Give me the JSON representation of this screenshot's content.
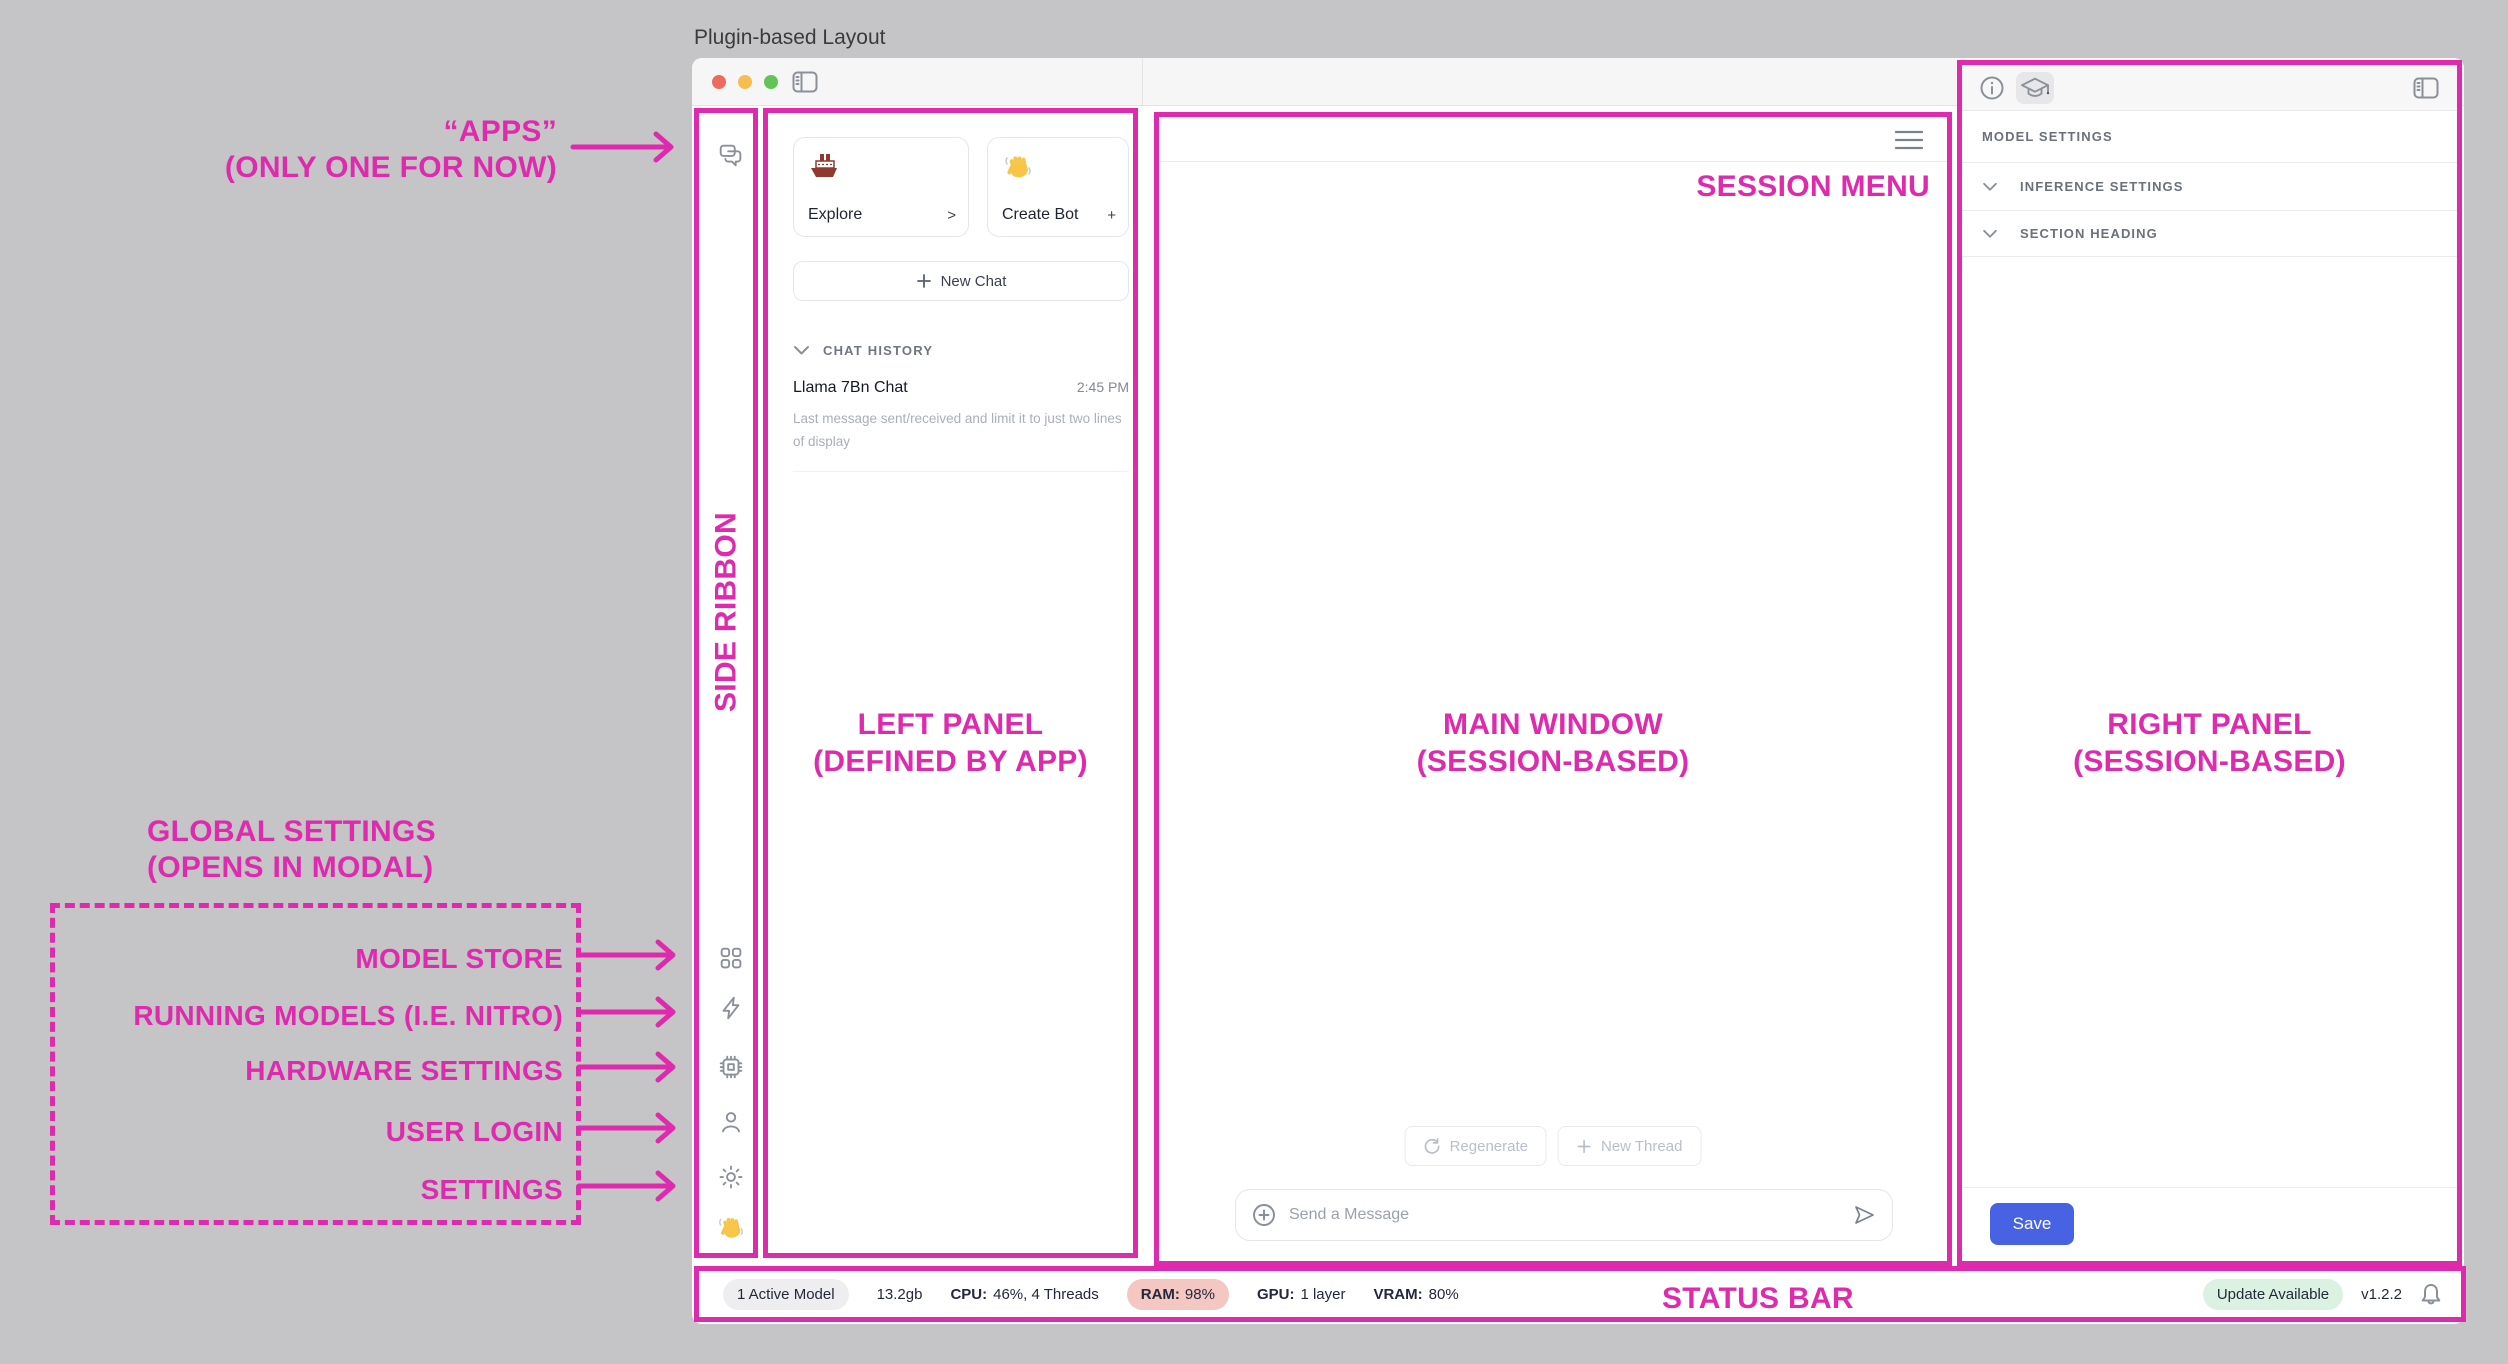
{
  "page": {
    "title": "Plugin-based Layout"
  },
  "side_ribbon": {
    "app_icons": [
      {
        "name": "chat-bubbles"
      }
    ],
    "global_icons": [
      {
        "name": "model-store-grid"
      },
      {
        "name": "running-models-bolt"
      },
      {
        "name": "hardware-cpu"
      },
      {
        "name": "user-login"
      },
      {
        "name": "settings-gear"
      },
      {
        "name": "wave-emoji",
        "emoji": "👋"
      }
    ]
  },
  "left_panel": {
    "cards": [
      {
        "emoji": "🚢",
        "label": "Explore",
        "accessory": ">"
      },
      {
        "emoji": "👋",
        "label": "Create Bot",
        "accessory": "+"
      }
    ],
    "new_chat_label": "New Chat",
    "history": {
      "header": "CHAT HISTORY",
      "items": [
        {
          "title": "Llama 7Bn Chat",
          "time": "2:45 PM",
          "preview": "Last message sent/received and limit it to just two lines of display"
        }
      ]
    }
  },
  "main_window": {
    "regenerate_label": "Regenerate",
    "new_thread_label": "New Thread",
    "composer_placeholder": "Send a Message"
  },
  "right_panel": {
    "header_tabs": [
      {
        "name": "info"
      },
      {
        "name": "model-settings",
        "selected": true
      }
    ],
    "section_title": "MODEL SETTINGS",
    "sections": [
      {
        "label": "INFERENCE SETTINGS"
      },
      {
        "label": "SECTION HEADING"
      }
    ],
    "save_label": "Save"
  },
  "status_bar": {
    "active_model": "1 Active Model",
    "memory": "13.2gb",
    "cpu_label": "CPU:",
    "cpu_value": "46%, 4 Threads",
    "ram_label": "RAM:",
    "ram_value": "98%",
    "gpu_label": "GPU:",
    "gpu_value": "1 layer",
    "vram_label": "VRAM:",
    "vram_value": "80%",
    "update_badge": "Update Available",
    "version": "v1.2.2"
  },
  "annotations": {
    "apps_line1": "“APPS”",
    "apps_line2": "(ONLY ONE FOR NOW)",
    "side_ribbon": "SIDE RIBBON",
    "left_panel_line1": "LEFT PANEL",
    "left_panel_line2": "(DEFINED BY APP)",
    "main_window_line1": "MAIN WINDOW",
    "main_window_line2": "(SESSION-BASED)",
    "right_panel_line1": "RIGHT PANEL",
    "right_panel_line2": "(SESSION-BASED)",
    "session_menu": "SESSION MENU",
    "status_bar": "STATUS BAR",
    "global_line1": "GLOBAL SETTINGS",
    "global_line2": "(OPENS IN MODAL)",
    "items": [
      "MODEL STORE",
      "RUNNING MODELS (I.E. NITRO)",
      "HARDWARE SETTINGS",
      "USER LOGIN",
      "SETTINGS"
    ]
  },
  "colors": {
    "annotation_accent": "#DE2BAD",
    "save_button": "#4763E4",
    "ram_pill": "#F4C7C2",
    "update_pill": "#DBF2E3",
    "active_model_pill": "#EEEEF0"
  }
}
